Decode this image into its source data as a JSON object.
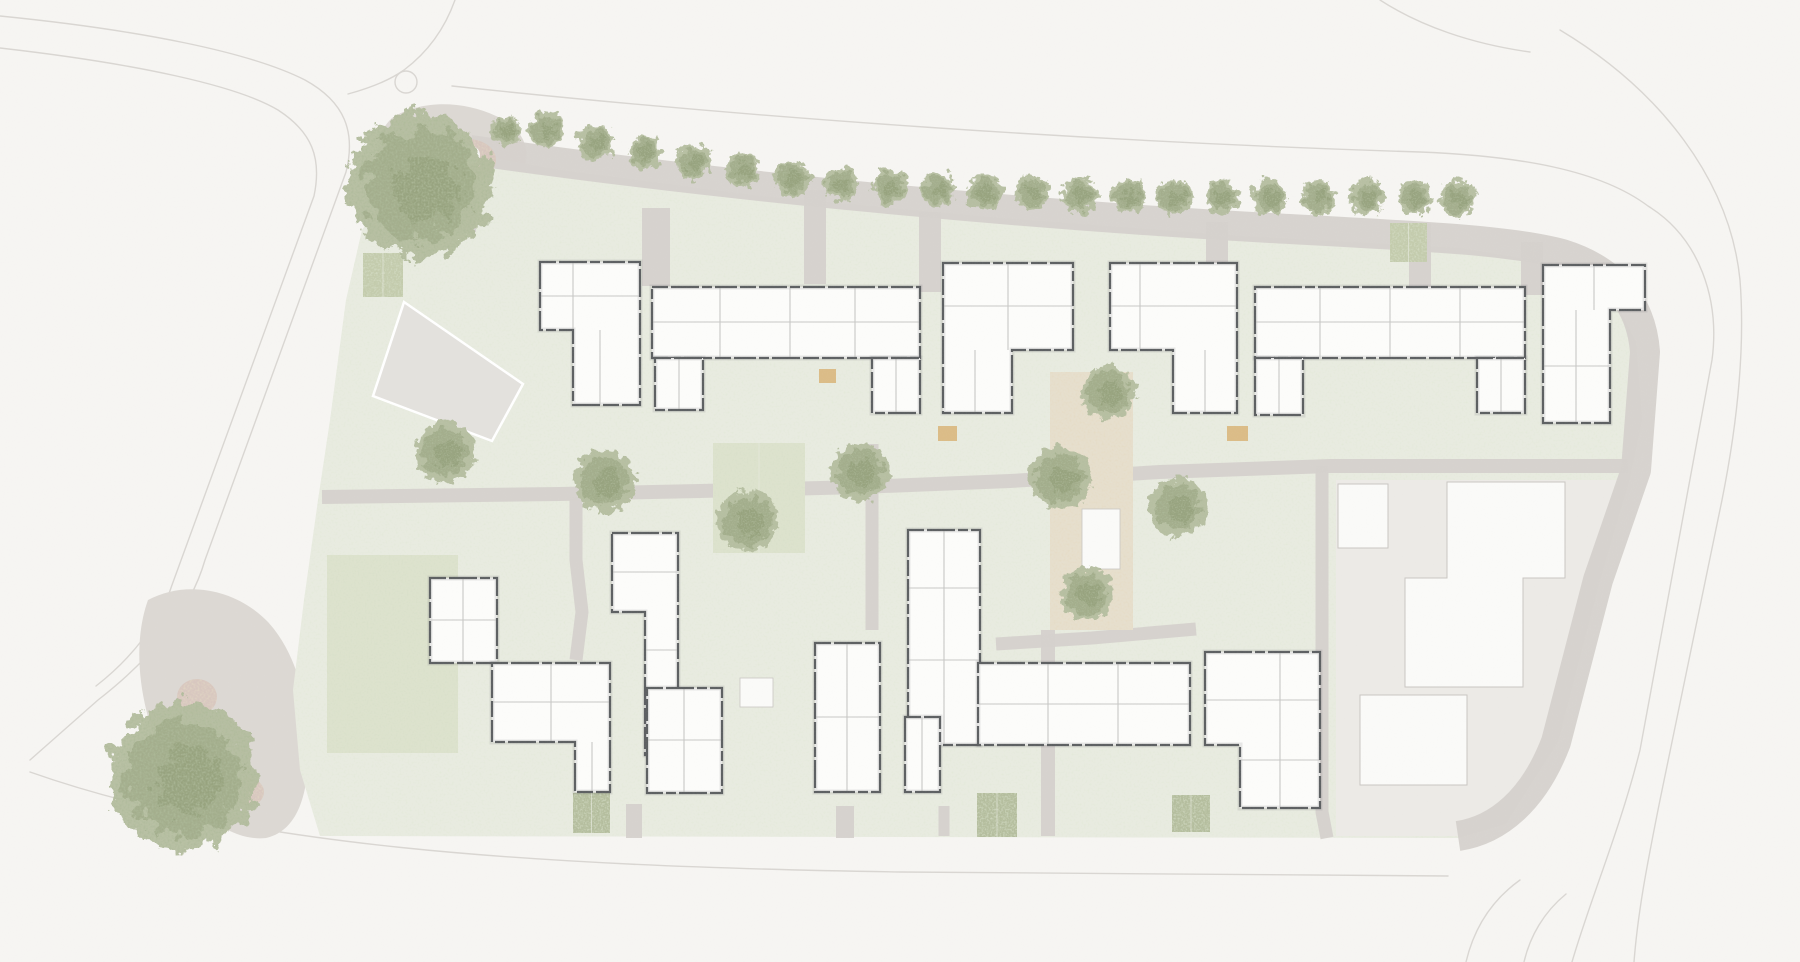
{
  "canvas": {
    "w": 1800,
    "h": 962
  },
  "colors": {
    "background": "#f6f5f2",
    "road_line": "#d9d6d2",
    "pavement": "#dcd8d3",
    "path": "#d5d1cc",
    "grass": "#e8ebe0",
    "grass_dot": "#c6d0ba",
    "lawn": "#dde2cd",
    "hedge": "#c3cbac",
    "hedge_dark": "#b4bd9d",
    "courtyard": "#e6dfcd",
    "neighbor_zone": "#eceae6",
    "neighbor_building": "#fafaf8",
    "neighbor_outline": "#c9c6c2",
    "building_fill": "#fcfcfa",
    "building_wall": "#5d6062",
    "building_inner": "#c7c7c5",
    "parking": "#e3e1dd",
    "parking_outline": "#ffffff",
    "tree_light": "#b4bd9f",
    "tree_mid": "#9aa681",
    "tree_dark": "#828f68",
    "deck": "#d9b77d",
    "pink": "#d8c5bc",
    "white": "#f6f5f2"
  },
  "roads": [
    "M 0,16 C 140,30 250,52 305,80 C 345,102 356,132 346,172 L 205,560 C 190,612 152,658 98,700 L 30,760",
    "M 0,48 C 140,64 238,86 278,110 C 312,132 322,158 314,196 L 172,585 C 160,622 132,658 96,686",
    "M 455,0 C 445,28 428,52 404,70 C 390,80 370,88 348,94",
    "M 452,86 C 750,118 1100,142 1420,152 C 1520,156 1600,170 1648,206 C 1700,238 1720,300 1712,360 L 1640,750 C 1620,830 1590,900 1572,962",
    "M 1560,30 C 1660,90 1730,180 1740,280 C 1745,345 1738,420 1722,500 L 1660,800 C 1648,860 1638,910 1634,962",
    "M 1380,0 C 1420,26 1472,44 1530,52",
    "M 30,772 C 240,846 520,866 900,872 L 1448,876",
    "M 1466,962 C 1474,928 1492,900 1520,880",
    "M 1524,962 C 1530,936 1544,912 1566,894"
  ],
  "roundabout": {
    "cx": 406,
    "cy": 82,
    "r": 11
  },
  "pavement_blobs": [
    "M 392,118 C 420,100 462,100 496,116 C 528,130 536,158 514,186 C 488,216 440,216 410,196 C 380,176 368,140 392,118 Z",
    "M 148,600 C 185,580 235,588 268,622 C 298,655 310,706 308,762 C 306,806 292,832 266,838 C 230,842 190,810 165,762 C 142,716 130,650 148,600 Z"
  ],
  "green_pts": "448,150 560,170 760,196 1000,218 1240,236 1460,248 1555,264 1612,294 1636,342 1642,420 1630,478 1600,580 1558,742 1505,824 1458,838 320,836 300,770 293,690 304,600 318,500 330,420 346,300 362,230 396,180",
  "neighbor_zone_pts": "1336,480 1622,480 1600,575 1558,740 1506,824 1460,836 1336,836",
  "parking_pts": "404,302 523,384 492,441 373,396",
  "lawn": {
    "x": 327,
    "y": 555,
    "w": 131,
    "h": 198
  },
  "courtyard": {
    "x": 1050,
    "y": 372,
    "w": 83,
    "h": 258
  },
  "paths": [
    {
      "d": "M 470,150 C 720,186 1020,214 1270,228 C 1420,236 1510,240 1562,254 C 1620,272 1642,310 1645,352 L 1636,470 L 1598,580 L 1556,742 C 1534,800 1498,830 1458,836",
      "w": 30
    },
    {
      "d": "M 322,497 L 560,494 L 700,491 L 860,487 L 1010,481 L 1160,472 L 1330,466 L 1628,466",
      "w": 14
    },
    {
      "d": "M 467,158 L 467,232",
      "w": 18
    },
    {
      "d": "M 656,208 L 656,286",
      "w": 28
    },
    {
      "d": "M 815,190 L 815,284",
      "w": 22
    },
    {
      "d": "M 930,212 L 930,292",
      "w": 22
    },
    {
      "d": "M 1217,222 L 1217,289",
      "w": 22
    },
    {
      "d": "M 1420,224 L 1420,289",
      "w": 22
    },
    {
      "d": "M 1532,242 L 1532,295",
      "w": 22
    },
    {
      "d": "M 576,497 L 576,560 L 582,612 L 576,660",
      "w": 13
    },
    {
      "d": "M 872,444 L 872,630",
      "w": 13
    },
    {
      "d": "M 1048,630 L 1048,836",
      "w": 14
    },
    {
      "d": "M 1322,466 L 1322,812 L 1327,838",
      "w": 13
    },
    {
      "d": "M 996,644 L 1092,638 L 1196,629",
      "w": 13
    },
    {
      "d": "M 634,804 L 634,838",
      "w": 16
    },
    {
      "d": "M 845,806 L 845,838",
      "w": 18
    },
    {
      "d": "M 944,806 L 944,836",
      "w": 11
    }
  ],
  "hedges": [
    {
      "x": 363,
      "y": 253,
      "w": 40,
      "h": 44,
      "tone": "hedge"
    },
    {
      "x": 713,
      "y": 443,
      "w": 92,
      "h": 110,
      "tone": "lawn"
    },
    {
      "x": 1390,
      "y": 223,
      "w": 37,
      "h": 39,
      "tone": "hedge"
    },
    {
      "x": 977,
      "y": 793,
      "w": 40,
      "h": 44,
      "tone": "hedge_dark"
    },
    {
      "x": 1172,
      "y": 795,
      "w": 38,
      "h": 37,
      "tone": "hedge_dark"
    },
    {
      "x": 573,
      "y": 793,
      "w": 37,
      "h": 40,
      "tone": "hedge_dark"
    }
  ],
  "decks": [
    {
      "x": 584,
      "y": 369,
      "w": 17,
      "h": 14
    },
    {
      "x": 819,
      "y": 369,
      "w": 17,
      "h": 14
    },
    {
      "x": 938,
      "y": 426,
      "w": 19,
      "h": 15
    },
    {
      "x": 1227,
      "y": 426,
      "w": 21,
      "h": 15
    }
  ],
  "pinks": [
    {
      "cx": 468,
      "cy": 160,
      "rx": 28,
      "ry": 21
    },
    {
      "cx": 197,
      "cy": 697,
      "rx": 20,
      "ry": 18
    },
    {
      "cx": 248,
      "cy": 792,
      "rx": 16,
      "ry": 14
    }
  ],
  "plaza_dot": {
    "cx": 471,
    "cy": 155,
    "r": 9
  },
  "white_marks": [
    {
      "x": 1082,
      "y": 509,
      "w": 38,
      "h": 60
    },
    {
      "x": 740,
      "y": 678,
      "w": 33,
      "h": 29
    }
  ],
  "buildings": [
    {
      "pts": "540,262 640,262 640,405 573,405 573,330 540,330",
      "inner": [
        [
          573,
          262,
          573,
          330
        ],
        [
          540,
          296,
          640,
          296
        ],
        [
          600,
          330,
          600,
          405
        ]
      ]
    },
    {
      "pts": "652,287 920,287 920,358 652,358",
      "inner": [
        [
          720,
          287,
          720,
          358
        ],
        [
          790,
          287,
          790,
          358
        ],
        [
          855,
          287,
          855,
          358
        ],
        [
          652,
          322,
          920,
          322
        ]
      ]
    },
    {
      "pts": "655,358 703,358 703,410 655,410",
      "inner": [
        [
          679,
          358,
          679,
          410
        ]
      ]
    },
    {
      "pts": "872,358 920,358 920,413 872,413",
      "inner": [
        [
          896,
          358,
          896,
          413
        ]
      ]
    },
    {
      "pts": "943,263 1073,263 1073,350 1012,350 1012,413 943,413",
      "inner": [
        [
          1008,
          263,
          1008,
          350
        ],
        [
          943,
          306,
          1073,
          306
        ],
        [
          975,
          350,
          975,
          413
        ]
      ]
    },
    {
      "pts": "1110,263 1237,263 1237,413 1173,413 1173,350 1110,350",
      "inner": [
        [
          1140,
          263,
          1140,
          350
        ],
        [
          1110,
          306,
          1237,
          306
        ],
        [
          1205,
          350,
          1205,
          413
        ]
      ]
    },
    {
      "pts": "1255,287 1525,287 1525,358 1255,358",
      "inner": [
        [
          1320,
          287,
          1320,
          358
        ],
        [
          1390,
          287,
          1390,
          358
        ],
        [
          1460,
          287,
          1460,
          358
        ],
        [
          1255,
          322,
          1525,
          322
        ]
      ]
    },
    {
      "pts": "1255,358 1303,358 1303,415 1255,415",
      "inner": [
        [
          1279,
          358,
          1279,
          415
        ]
      ]
    },
    {
      "pts": "1477,358 1525,358 1525,413 1477,413",
      "inner": [
        [
          1501,
          358,
          1501,
          413
        ]
      ]
    },
    {
      "pts": "1543,265 1645,265 1645,310 1610,310 1610,423 1543,423",
      "inner": [
        [
          1594,
          265,
          1594,
          310
        ],
        [
          1576,
          310,
          1576,
          423
        ],
        [
          1543,
          366,
          1610,
          366
        ]
      ]
    },
    {
      "pts": "612,533 678,533 678,755 645,755 645,612 612,612",
      "inner": [
        [
          612,
          572,
          678,
          572
        ],
        [
          645,
          650,
          678,
          650
        ],
        [
          645,
          700,
          678,
          700
        ]
      ]
    },
    {
      "pts": "647,688 722,688 722,793 647,793",
      "inner": [
        [
          647,
          740,
          722,
          740
        ],
        [
          684,
          688,
          684,
          793
        ]
      ]
    },
    {
      "pts": "430,578 497,578 497,663 430,663",
      "inner": [
        [
          430,
          620,
          497,
          620
        ],
        [
          463,
          578,
          463,
          663
        ]
      ]
    },
    {
      "pts": "492,663 610,663 610,792 575,792 575,742 492,742",
      "inner": [
        [
          551,
          663,
          551,
          742
        ],
        [
          492,
          702,
          610,
          702
        ],
        [
          592,
          742,
          592,
          792
        ]
      ]
    },
    {
      "pts": "815,643 880,643 880,792 815,792",
      "inner": [
        [
          815,
          717,
          880,
          717
        ],
        [
          847,
          643,
          847,
          792
        ]
      ]
    },
    {
      "pts": "908,530 980,530 980,745 908,745",
      "inner": [
        [
          908,
          588,
          980,
          588
        ],
        [
          908,
          660,
          980,
          660
        ],
        [
          944,
          530,
          944,
          745
        ]
      ]
    },
    {
      "pts": "905,717 940,717 940,792 905,792",
      "inner": [
        [
          922,
          717,
          922,
          792
        ]
      ]
    },
    {
      "pts": "978,663 1190,663 1190,745 978,745",
      "inner": [
        [
          1048,
          663,
          1048,
          745
        ],
        [
          1118,
          663,
          1118,
          745
        ],
        [
          978,
          704,
          1190,
          704
        ]
      ]
    },
    {
      "pts": "1205,652 1320,652 1320,808 1240,808 1240,745 1205,745",
      "inner": [
        [
          1280,
          652,
          1280,
          808
        ],
        [
          1205,
          700,
          1320,
          700
        ],
        [
          1240,
          760,
          1320,
          760
        ]
      ]
    }
  ],
  "neighbor_buildings": [
    {
      "pts": "1338,484 1388,484 1388,548 1338,548"
    },
    {
      "pts": "1447,482 1565,482 1565,578 1523,578 1523,687 1405,687 1405,578 1447,578"
    },
    {
      "pts": "1360,695 1467,695 1467,785 1360,785"
    }
  ],
  "trees": {
    "big": [
      {
        "x": 420,
        "y": 185,
        "r": 72
      },
      {
        "x": 183,
        "y": 777,
        "r": 74
      }
    ],
    "street": [
      {
        "x": 505,
        "y": 130,
        "r": 15
      },
      {
        "x": 546,
        "y": 130,
        "r": 17
      },
      {
        "x": 595,
        "y": 142,
        "r": 18
      },
      {
        "x": 645,
        "y": 152,
        "r": 17
      },
      {
        "x": 694,
        "y": 162,
        "r": 18
      },
      {
        "x": 743,
        "y": 170,
        "r": 17
      },
      {
        "x": 792,
        "y": 178,
        "r": 18
      },
      {
        "x": 841,
        "y": 184,
        "r": 17
      },
      {
        "x": 890,
        "y": 187,
        "r": 18
      },
      {
        "x": 938,
        "y": 190,
        "r": 17
      },
      {
        "x": 985,
        "y": 192,
        "r": 18
      },
      {
        "x": 1032,
        "y": 193,
        "r": 17
      },
      {
        "x": 1080,
        "y": 195,
        "r": 18
      },
      {
        "x": 1128,
        "y": 196,
        "r": 17
      },
      {
        "x": 1175,
        "y": 197,
        "r": 18
      },
      {
        "x": 1222,
        "y": 197,
        "r": 17
      },
      {
        "x": 1270,
        "y": 197,
        "r": 18
      },
      {
        "x": 1318,
        "y": 197,
        "r": 17
      },
      {
        "x": 1367,
        "y": 197,
        "r": 18
      },
      {
        "x": 1415,
        "y": 197,
        "r": 17
      },
      {
        "x": 1458,
        "y": 198,
        "r": 18
      }
    ],
    "garden": [
      {
        "x": 445,
        "y": 452,
        "r": 30
      },
      {
        "x": 605,
        "y": 481,
        "r": 31
      },
      {
        "x": 748,
        "y": 521,
        "r": 31
      },
      {
        "x": 860,
        "y": 472,
        "r": 29
      },
      {
        "x": 1108,
        "y": 392,
        "r": 27
      },
      {
        "x": 1060,
        "y": 478,
        "r": 31
      },
      {
        "x": 1178,
        "y": 507,
        "r": 29
      },
      {
        "x": 1087,
        "y": 594,
        "r": 26
      }
    ]
  }
}
